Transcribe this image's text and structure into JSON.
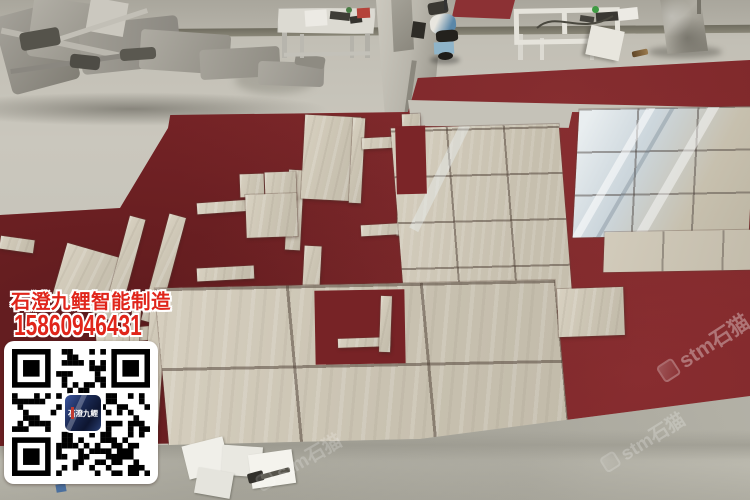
{
  "overlay": {
    "company_name": "石澄九鲤智能制造",
    "phone_number": "15860946431",
    "qr_logo_text": "石澄九鲤",
    "text_color": "#e0251b"
  },
  "watermark": {
    "text": "stm石猫",
    "color": "#ffffff"
  },
  "colors": {
    "carpet_red": "#7b2528",
    "carpet_red_light": "#8c3134",
    "tile_beige": "#ccc5b4",
    "concrete": "#c3c0b6",
    "qr_logo_bg": "#1b2a55"
  }
}
